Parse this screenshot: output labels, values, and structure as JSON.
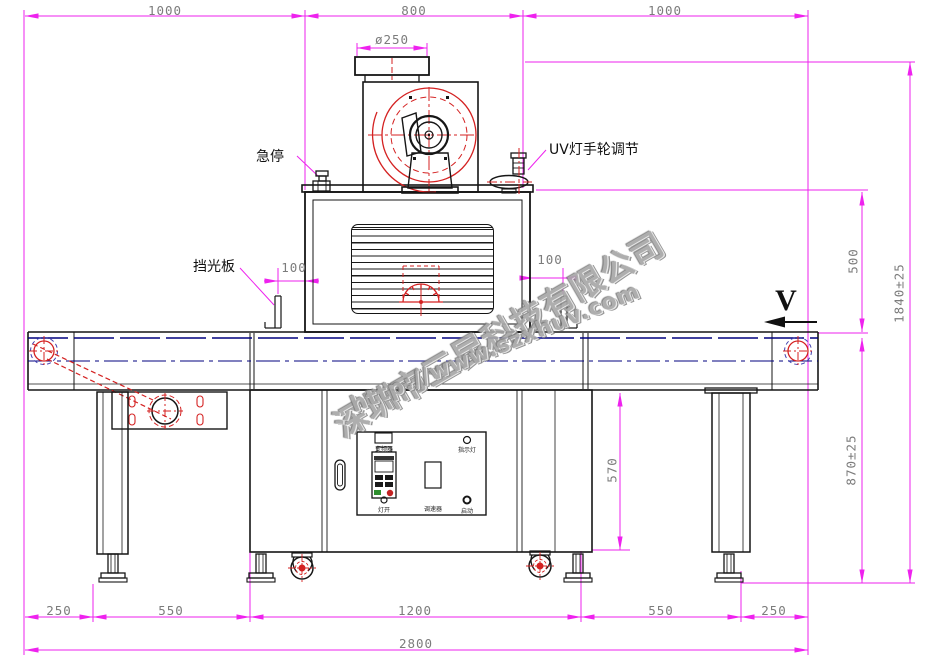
{
  "dims": {
    "top_left": "1000",
    "top_center": "800",
    "top_right": "1000",
    "duct": "ø250",
    "shield_left": "100",
    "shield_right": "100",
    "lamp_to_belt": "500",
    "overall_height": "1840±25",
    "belt_height": "870±25",
    "cabinet_height": "570",
    "bottom_1": "250",
    "bottom_2": "550",
    "bottom_3": "1200",
    "bottom_4": "550",
    "bottom_5": "250",
    "overall_width": "2800"
  },
  "labels": {
    "emergency_stop": "急停",
    "uv_handwheel": "UV灯手轮调节",
    "light_shield": "挡光板",
    "belt_direction": "V"
  },
  "panel": {
    "inverter": "变频器",
    "lamp_switch": "灯开",
    "speed_controller": "调速器",
    "indicator_light": "指示灯",
    "start": "启动"
  },
  "watermark": {
    "company": "深圳市三昆科技有限公司",
    "url": "http://www.szxhuv.com"
  }
}
